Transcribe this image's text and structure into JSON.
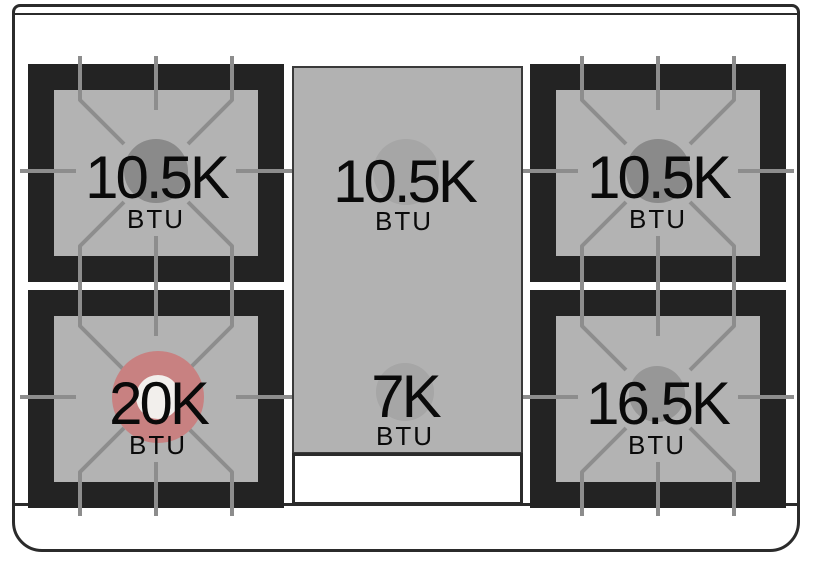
{
  "cooktop": {
    "description": "Gas range cooktop burner layout diagram",
    "unit_label": "BTU",
    "burners": [
      {
        "position": "top-left",
        "value": "10.5K",
        "unit": "BTU",
        "circle_color": "#8a8a8a"
      },
      {
        "position": "center-griddle-top",
        "value": "10.5K",
        "unit": "BTU",
        "circle_color": "#a6a6a6"
      },
      {
        "position": "top-right",
        "value": "10.5K",
        "unit": "BTU",
        "circle_color": "#8a8a8a"
      },
      {
        "position": "bottom-left",
        "value": "20K",
        "unit": "BTU",
        "circle_color": "#c88181",
        "inner_circle_color": "#f2efec"
      },
      {
        "position": "center-griddle-bottom",
        "value": "7K",
        "unit": "BTU",
        "circle_color": "#a6a6a6"
      },
      {
        "position": "bottom-right",
        "value": "16.5K",
        "unit": "BTU",
        "circle_color": "#979797"
      }
    ],
    "colors": {
      "frame_black": "#232323",
      "burner_surface": "#b3b3b3",
      "griddle_surface": "#b2b2b2",
      "griddle_tray_white": "#ffffff",
      "grate_line": "#8d8d8d",
      "outline": "#2b2b2b",
      "highlight_red": "#c88181",
      "text": "#0a0a0a"
    }
  }
}
